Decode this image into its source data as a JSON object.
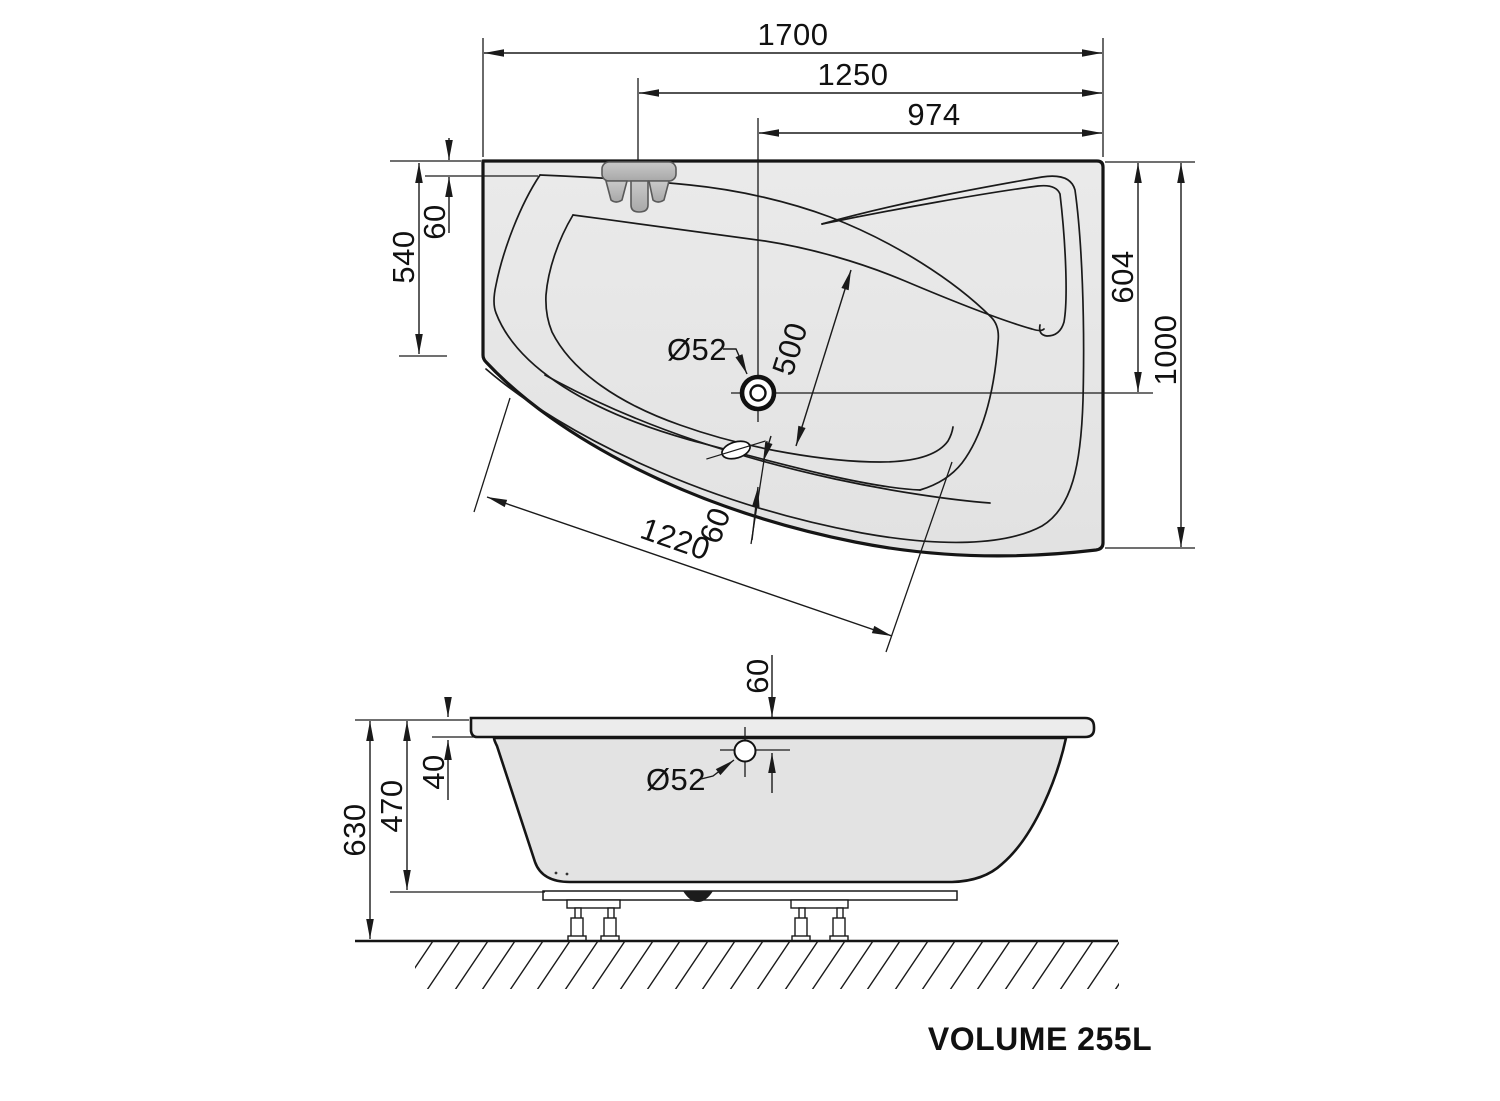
{
  "drawing": {
    "background": "#ffffff",
    "line_color": "#1a1a1a",
    "tub_fill": "#e7e7e7",
    "tub_fill_dark": "#dfdfdf",
    "faucet_fill": "#bcbcbc"
  },
  "top_view": {
    "dim_overall_length": "1700",
    "dim_faucet_to_end": "1250",
    "dim_drain_to_end": "974",
    "dim_left_depth": "540",
    "dim_rim_offset": "60",
    "dim_drain_axis": "604",
    "dim_overall_width": "1000",
    "dim_drain_diameter": "Ø52",
    "dim_diagonal_inner": "500",
    "dim_front_edge": "1220",
    "dim_front_rim_width": "60"
  },
  "side_view": {
    "dim_overflow_offset": "60",
    "dim_rim_height": "40",
    "dim_body_height": "470",
    "dim_total_height": "630",
    "dim_overflow_diameter": "Ø52"
  },
  "footer": {
    "volume_label": "VOLUME 255L"
  }
}
